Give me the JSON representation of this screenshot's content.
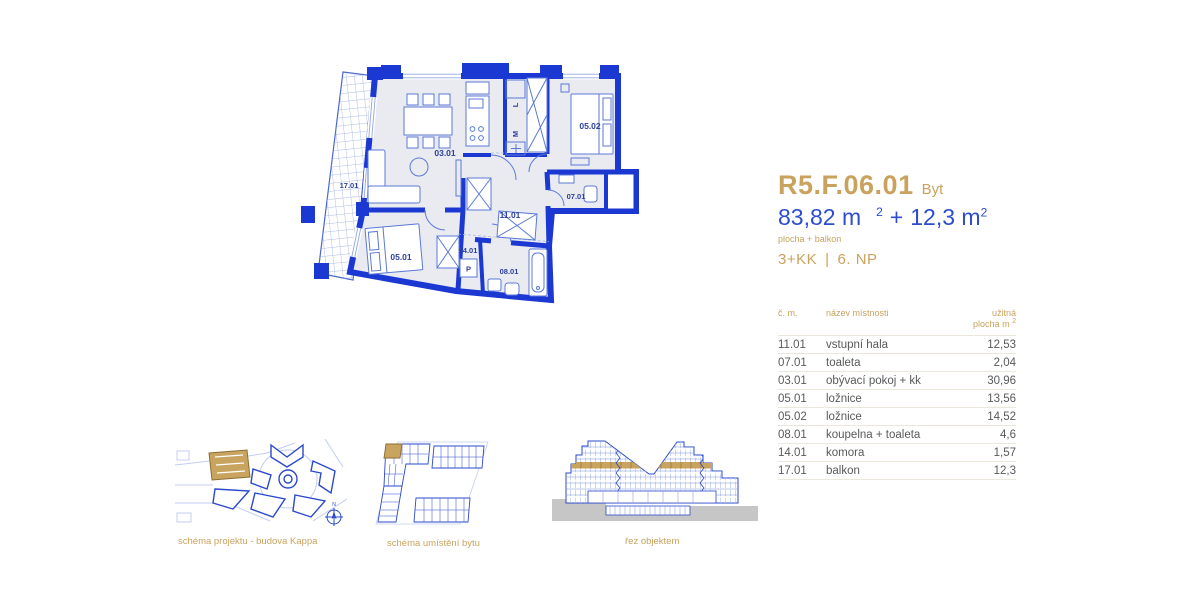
{
  "colors": {
    "accent_gold": "#c9a25e",
    "accent_blue": "#2d4ccf",
    "wall_blue": "#1c38d2",
    "line_blue": "#5b79d6",
    "light_blue": "#a8b8e8",
    "label_blue": "#2b3f9e",
    "room_fill": "#e9ebf1",
    "diagram_blue": "#2b49cc",
    "street_blue": "#c3cdf0",
    "ground_gray": "#c6c6c6",
    "table_text": "#58595b",
    "rule_color": "#ece7db"
  },
  "header": {
    "unit_code": "R5.F.06.01",
    "unit_type_label": "Byt",
    "area_main": "83,82 m",
    "area_main_sup": "2",
    "area_plus": "+",
    "area_balcony": "12,3 m",
    "area_balcony_sup": "2",
    "area_note": "plocha + balkon",
    "disposition": "3+KK",
    "separator": "|",
    "floor": "6. NP"
  },
  "rooms_table": {
    "col_num": "č. m.",
    "col_name": "název místnosti",
    "col_area_line1": "užitná",
    "col_area_line2": "plocha m",
    "col_area_sup": "2",
    "rows": [
      {
        "id": "11.01",
        "name": "vstupní hala",
        "area": "12,53"
      },
      {
        "id": "07.01",
        "name": "toaleta",
        "area": "2,04"
      },
      {
        "id": "03.01",
        "name": "obývací pokoj + kk",
        "area": "30,96"
      },
      {
        "id": "05.01",
        "name": "ložnice",
        "area": "13,56"
      },
      {
        "id": "05.02",
        "name": "ložnice",
        "area": "14,52"
      },
      {
        "id": "08.01",
        "name": "koupelna + toaleta",
        "area": "4,6"
      },
      {
        "id": "14.01",
        "name": "komora",
        "area": "1,57"
      },
      {
        "id": "17.01",
        "name": "balkon",
        "area": "12,3"
      }
    ]
  },
  "floor_plan": {
    "rooms": {
      "living": "03.01",
      "bedroom1": "05.01",
      "bedroom2": "05.02",
      "toilet": "07.01",
      "bathroom": "08.01",
      "hall": "11.01",
      "storage": "14.01",
      "balcony": "17.01"
    },
    "appliances": {
      "washer": "P",
      "fridge": "L",
      "microwave": "M"
    }
  },
  "compass": {
    "north": "N"
  },
  "diagrams": [
    {
      "caption": "schéma projektu - budova Kappa"
    },
    {
      "caption": "schéma umístění bytu"
    },
    {
      "caption": "řez objektem"
    }
  ]
}
